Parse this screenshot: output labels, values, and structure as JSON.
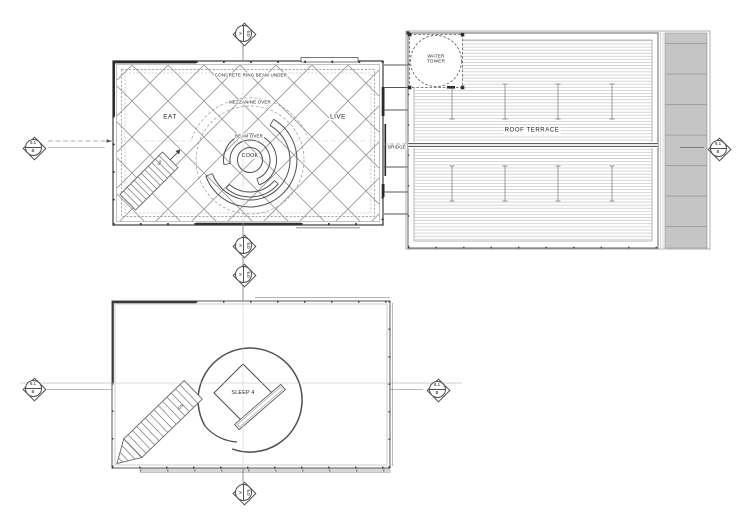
{
  "labels": {
    "concrete_ring_beam": "CONCRETE RING BEAM UNDER",
    "mezzanine_over": "MEZZANINE OVER",
    "eat": "EAT",
    "live": "LIVE",
    "beam_over": "BEAM OVER",
    "cook": "COOK",
    "up": "UP",
    "bridge": "BRIDGE",
    "roof_terrace": "ROOF TERRACE",
    "water_tower": "WATER\nTOWER",
    "sleep_4": "SLEEP 4",
    "dn": "DN"
  },
  "markers": {
    "section_60a": {
      "number": "6.0",
      "letter": "A"
    },
    "section_61b": {
      "number": "6.1",
      "letter": "B"
    }
  },
  "colors": {
    "line": "#4a4a4a",
    "diagrid": "#9a9a9a",
    "deck_line": "#b6b6b6",
    "ramp_fill": "#c5c5c5",
    "dashed": "#888888"
  }
}
